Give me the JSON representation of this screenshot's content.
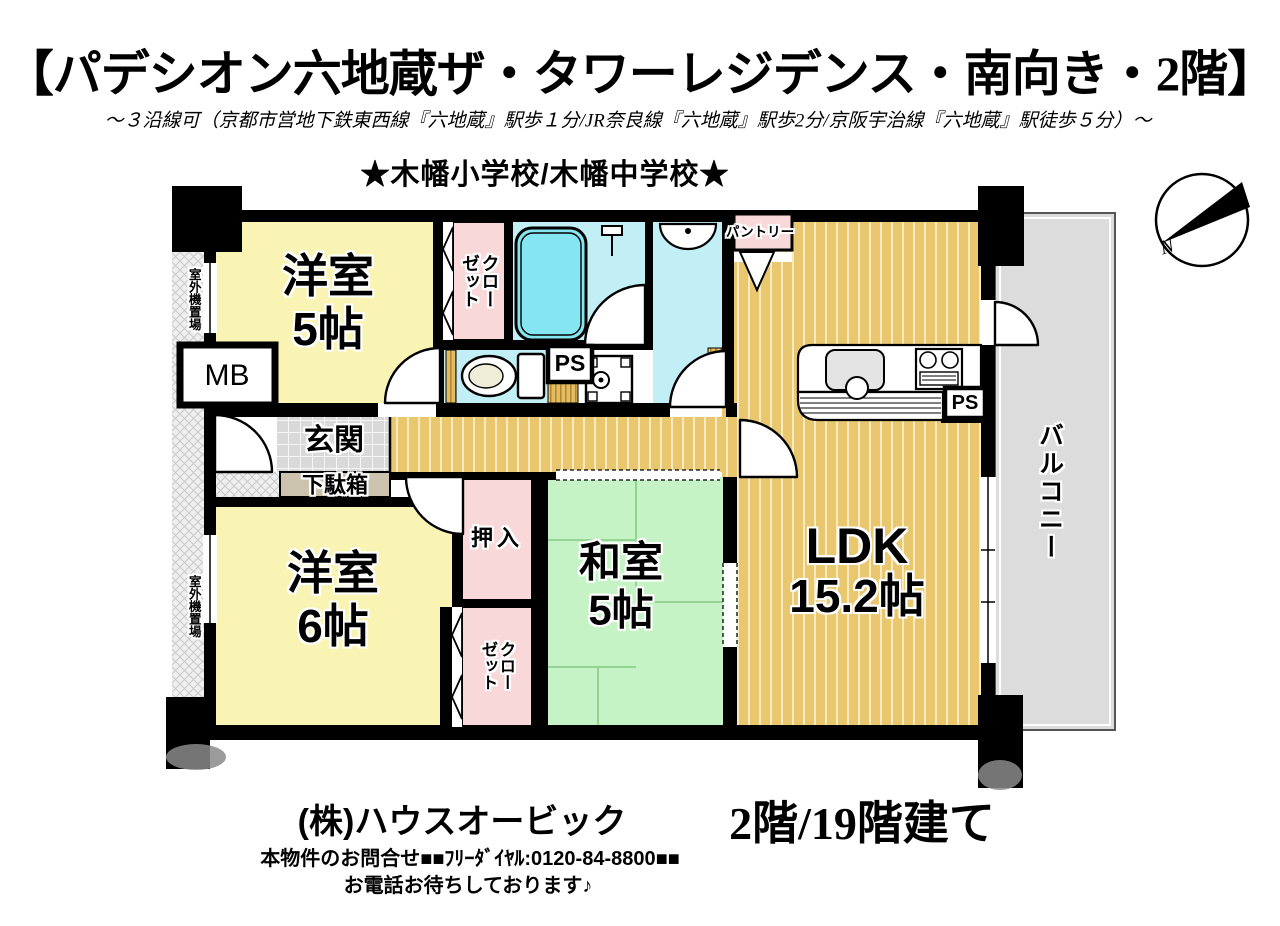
{
  "header": {
    "title": "【パデシオン六地蔵ザ・タワーレジデンス・南向き・2階】",
    "subtitle": "～３沿線可（京都市営地下鉄東西線『六地蔵』駅歩１分/JR奈良線『六地蔵』駅歩2分/京阪宇治線『六地蔵』駅徒歩５分）～",
    "schools": "★木幡小学校/木幡中学校★"
  },
  "plan": {
    "rooms": {
      "western1": {
        "label": "洋室",
        "size": "5帖"
      },
      "western2": {
        "label": "洋室",
        "size": "6帖"
      },
      "japanese": {
        "label": "和室",
        "size": "5帖"
      },
      "ldk": {
        "label": "LDK",
        "size": "15.2帖"
      },
      "closet_top": "クローゼット",
      "closet_bottom": "クローゼット",
      "oshiire": "押入",
      "pantry": "パントリー",
      "genkan": "玄関",
      "getabako": "下駄箱",
      "balcony": "バルコニー",
      "outdoor_unit_top": "室外機置場",
      "outdoor_unit_bottom": "室外機置場",
      "mb": "MB",
      "ps_top": "PS",
      "ps_kitchen": "PS"
    },
    "compass_n": "N"
  },
  "footer": {
    "company": "(株)ハウスオービック",
    "floor_info": "2階/19階建て",
    "contact": "本物件のお問合せ■■ﾌﾘｰﾀﾞｲﾔﾙ:0120-84-8800■■",
    "message": "お電話お待ちしております♪"
  },
  "colors": {
    "room_yellow": "#FAF4B4",
    "closet_pink": "#F8D8D8",
    "wet_cyan": "#C2EEF6",
    "tub_cyan": "#85E5F0",
    "tatami_green": "#C6F3C6",
    "flooring_tan": "#E9C76F",
    "balcony_gray": "#DCDCDC",
    "genkan_gray": "#D9D9D9",
    "getabako_tan": "#CCC3AE",
    "wall_black": "#000000"
  }
}
